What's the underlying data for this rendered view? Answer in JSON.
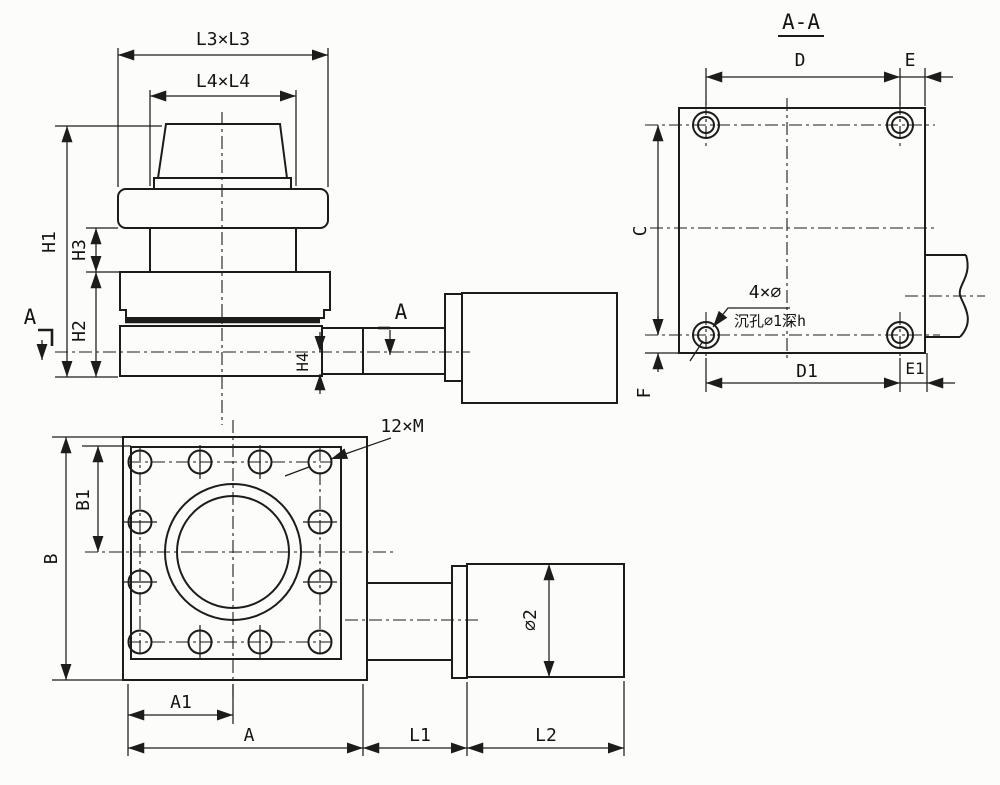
{
  "drawing": {
    "type": "engineering-drawing",
    "background_color": "#fcfcfa",
    "line_color": "#1c1c1c",
    "side_view": {
      "dim_l3": "L3×L3",
      "dim_l4": "L4×L4",
      "dim_h1": "H1",
      "dim_h3": "H3",
      "dim_h2": "H2",
      "dim_h4": "H4",
      "section_label_left": "A",
      "section_label_shaft": "A"
    },
    "section_view": {
      "title": "A-A",
      "dim_d": "D",
      "dim_e": "E",
      "dim_c": "C",
      "dim_f": "F",
      "dim_d1": "D1",
      "dim_e1": "E1",
      "hole_note_line1": "4×∅",
      "hole_note_line2": "沉孔∅1深h"
    },
    "front_view": {
      "thread_note": "12×M",
      "dim_b": "B",
      "dim_b1": "B1",
      "dim_a1": "A1",
      "dim_a": "A",
      "dim_l1": "L1",
      "dim_l2": "L2",
      "dim_phi2": "∅2"
    }
  }
}
